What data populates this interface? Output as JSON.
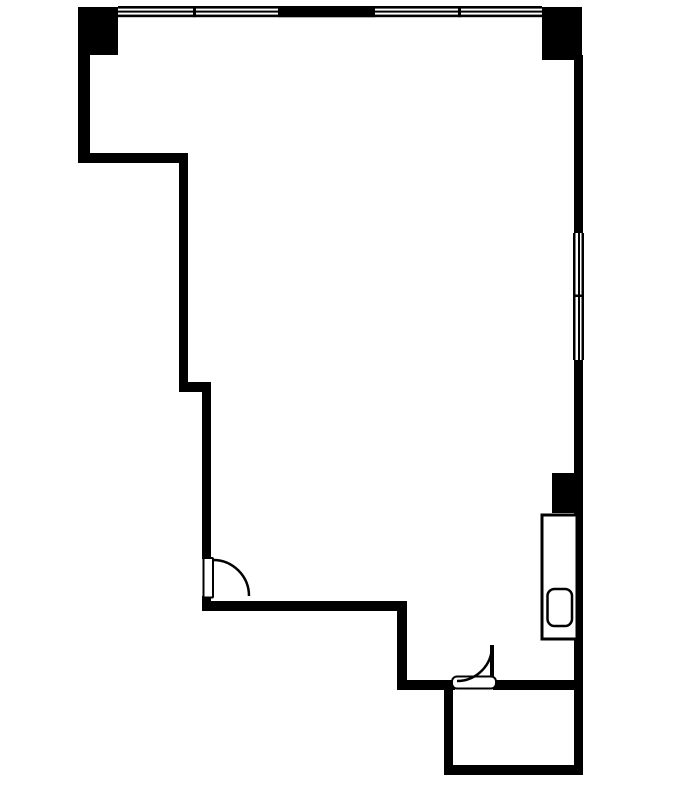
{
  "canvas": {
    "width": 693,
    "height": 787,
    "background_color": "#ffffff",
    "ink_color": "#000000"
  },
  "plan": {
    "description": "floor-plan line drawing, no text labels visible",
    "walls": [
      {
        "name": "column-top-left",
        "x": 78,
        "y": 7,
        "w": 40,
        "h": 48
      },
      {
        "name": "column-top-right",
        "x": 542,
        "y": 7,
        "w": 40,
        "h": 53
      },
      {
        "name": "top-window-line-outer",
        "x": 118,
        "y": 6,
        "w": 424,
        "h": 2.6
      },
      {
        "name": "top-window-line-mid",
        "x": 118,
        "y": 10.6,
        "w": 424,
        "h": 2
      },
      {
        "name": "top-window-line-inner",
        "x": 118,
        "y": 14.6,
        "w": 424,
        "h": 2.6
      },
      {
        "name": "top-wall-solid-middle",
        "x": 278,
        "y": 6,
        "w": 97,
        "h": 11.2
      },
      {
        "name": "top-window-mullion-left",
        "x": 193,
        "y": 6,
        "w": 3,
        "h": 11.2
      },
      {
        "name": "top-window-mullion-right",
        "x": 458,
        "y": 6,
        "w": 3,
        "h": 11.2
      },
      {
        "name": "wall-left-upper",
        "x": 78,
        "y": 55,
        "w": 12,
        "h": 108
      },
      {
        "name": "wall-step-upper",
        "x": 78,
        "y": 153,
        "w": 110,
        "h": 10
      },
      {
        "name": "wall-left-middle",
        "x": 179,
        "y": 153,
        "w": 9,
        "h": 239
      },
      {
        "name": "wall-step-lower",
        "x": 179,
        "y": 382,
        "w": 32,
        "h": 10
      },
      {
        "name": "wall-left-lower",
        "x": 202,
        "y": 382,
        "w": 9,
        "h": 177
      },
      {
        "name": "wall-left-door-stub",
        "x": 202,
        "y": 596,
        "w": 9,
        "h": 15
      },
      {
        "name": "wall-bottom-west",
        "x": 202,
        "y": 601,
        "w": 205,
        "h": 10
      },
      {
        "name": "wall-vertical-mid",
        "x": 397,
        "y": 601,
        "w": 10,
        "h": 89
      },
      {
        "name": "wall-bottom-center",
        "x": 397,
        "y": 680,
        "w": 58,
        "h": 10
      },
      {
        "name": "wall-bottom-east",
        "x": 493,
        "y": 680,
        "w": 90,
        "h": 10
      },
      {
        "name": "wall-smallroom-left",
        "x": 444,
        "y": 680,
        "w": 9,
        "h": 95
      },
      {
        "name": "wall-smallroom-bottom",
        "x": 444,
        "y": 765,
        "w": 139,
        "h": 10
      },
      {
        "name": "wall-right-upper",
        "x": 574,
        "y": 55,
        "w": 9,
        "h": 178
      },
      {
        "name": "wall-right-lower",
        "x": 574,
        "y": 360,
        "w": 9,
        "h": 415
      },
      {
        "name": "right-window-line-outer",
        "x": 581.5,
        "y": 233,
        "w": 2.5,
        "h": 127
      },
      {
        "name": "right-window-line-mid",
        "x": 578,
        "y": 233,
        "w": 2,
        "h": 127
      },
      {
        "name": "right-window-line-inner",
        "x": 573,
        "y": 233,
        "w": 2.5,
        "h": 127
      },
      {
        "name": "right-window-mullion",
        "x": 573,
        "y": 294.5,
        "w": 11,
        "h": 2.5
      },
      {
        "name": "column-mid-right",
        "x": 552,
        "y": 473,
        "w": 22,
        "h": 40
      },
      {
        "name": "door-bottom-leaf",
        "x": 490,
        "y": 645,
        "w": 4,
        "h": 36
      }
    ],
    "outlines": [
      {
        "name": "shaft-fixture-outline",
        "x": 542,
        "y": 515,
        "w": 35,
        "h": 124,
        "sw": 3,
        "rx": 0
      },
      {
        "name": "fixture-unit",
        "x": 547.5,
        "y": 589,
        "w": 24.5,
        "h": 37,
        "sw": 2.5,
        "rx": 7
      },
      {
        "name": "door-left-leaf",
        "x": 203.5,
        "y": 558,
        "w": 9.5,
        "h": 39.5,
        "sw": 2,
        "rx": 1
      },
      {
        "name": "door-bottom-threshold",
        "x": 452,
        "y": 676.5,
        "w": 44,
        "h": 12,
        "sw": 2,
        "rx": 5
      }
    ],
    "arcs": [
      {
        "name": "door-left-swing-arc",
        "d": "M 213 560 A 36 36 0 0 1 249 596",
        "sw": 2.5
      },
      {
        "name": "door-bottom-swing-arc",
        "d": "M 457 681 A 35 35 0 0 0 492 646",
        "sw": 2.5
      }
    ]
  }
}
